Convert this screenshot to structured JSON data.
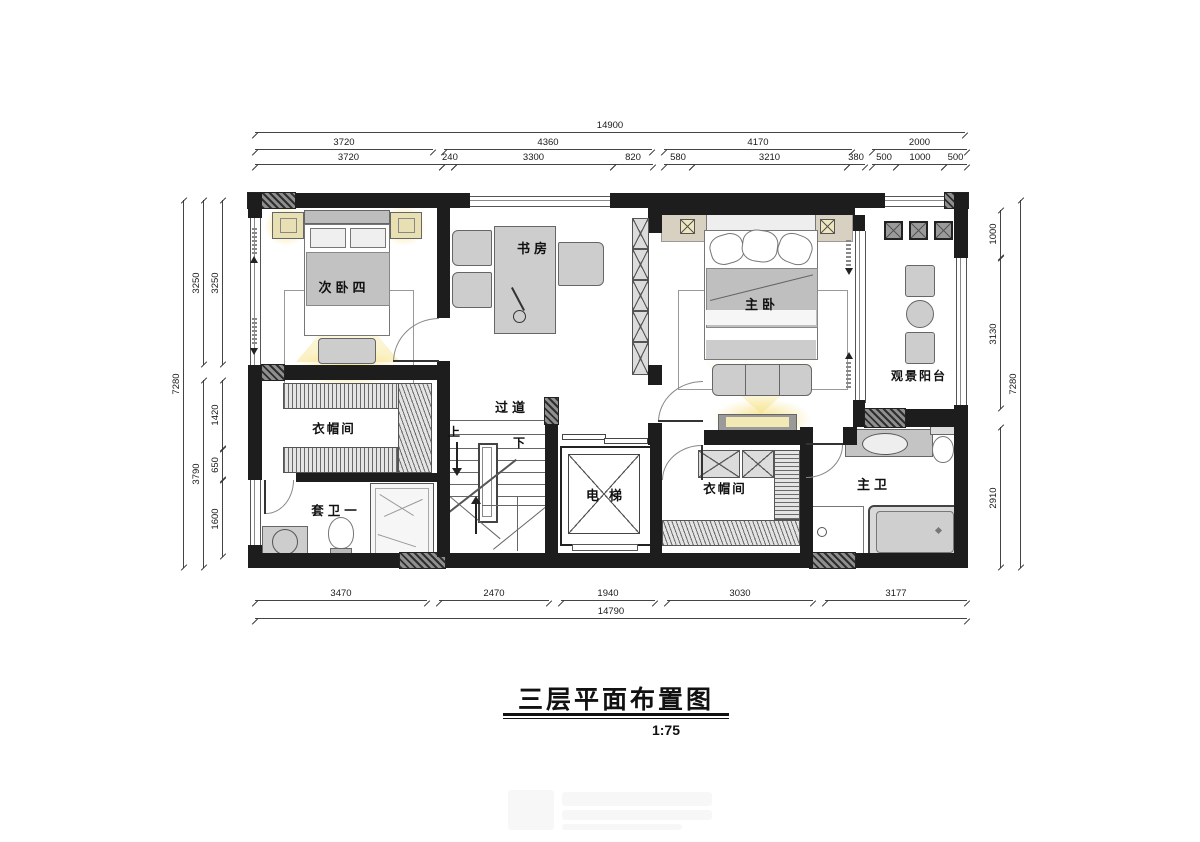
{
  "title": {
    "text": "三层平面布置图",
    "scale": "1:75"
  },
  "rooms": {
    "bedroom4": "次卧四",
    "study": "书房",
    "master": "主卧",
    "balcony": "观景阳台",
    "corridor": "过道",
    "cloakroom_left": "衣帽间",
    "bath_suite": "套卫一",
    "elevator": "电梯",
    "cloakroom_right": "衣帽间",
    "bath_master": "主卫"
  },
  "stairs": {
    "up": "上",
    "down": "下"
  },
  "dims": {
    "top": {
      "total": "14900",
      "row2": [
        "3720",
        "4360",
        "4170",
        "2000"
      ],
      "row3": [
        "3720",
        "240",
        "3300",
        "820",
        "580",
        "3210",
        "380",
        "500",
        "1000",
        "500"
      ]
    },
    "bottom": {
      "row": [
        "3470",
        "2470",
        "1940",
        "3030",
        "3177"
      ],
      "total": "14790"
    },
    "left": {
      "total": "7280",
      "mid": [
        "3250",
        "3790"
      ],
      "inner": [
        "3250",
        "1420",
        "650",
        "1600"
      ]
    },
    "right": {
      "inner": [
        "1000",
        "3130",
        "2910"
      ],
      "total": "7280"
    }
  },
  "colors": {
    "wall": "#1d1d1d",
    "glow": "#f6e082",
    "furniture": "#cdcdcd"
  }
}
